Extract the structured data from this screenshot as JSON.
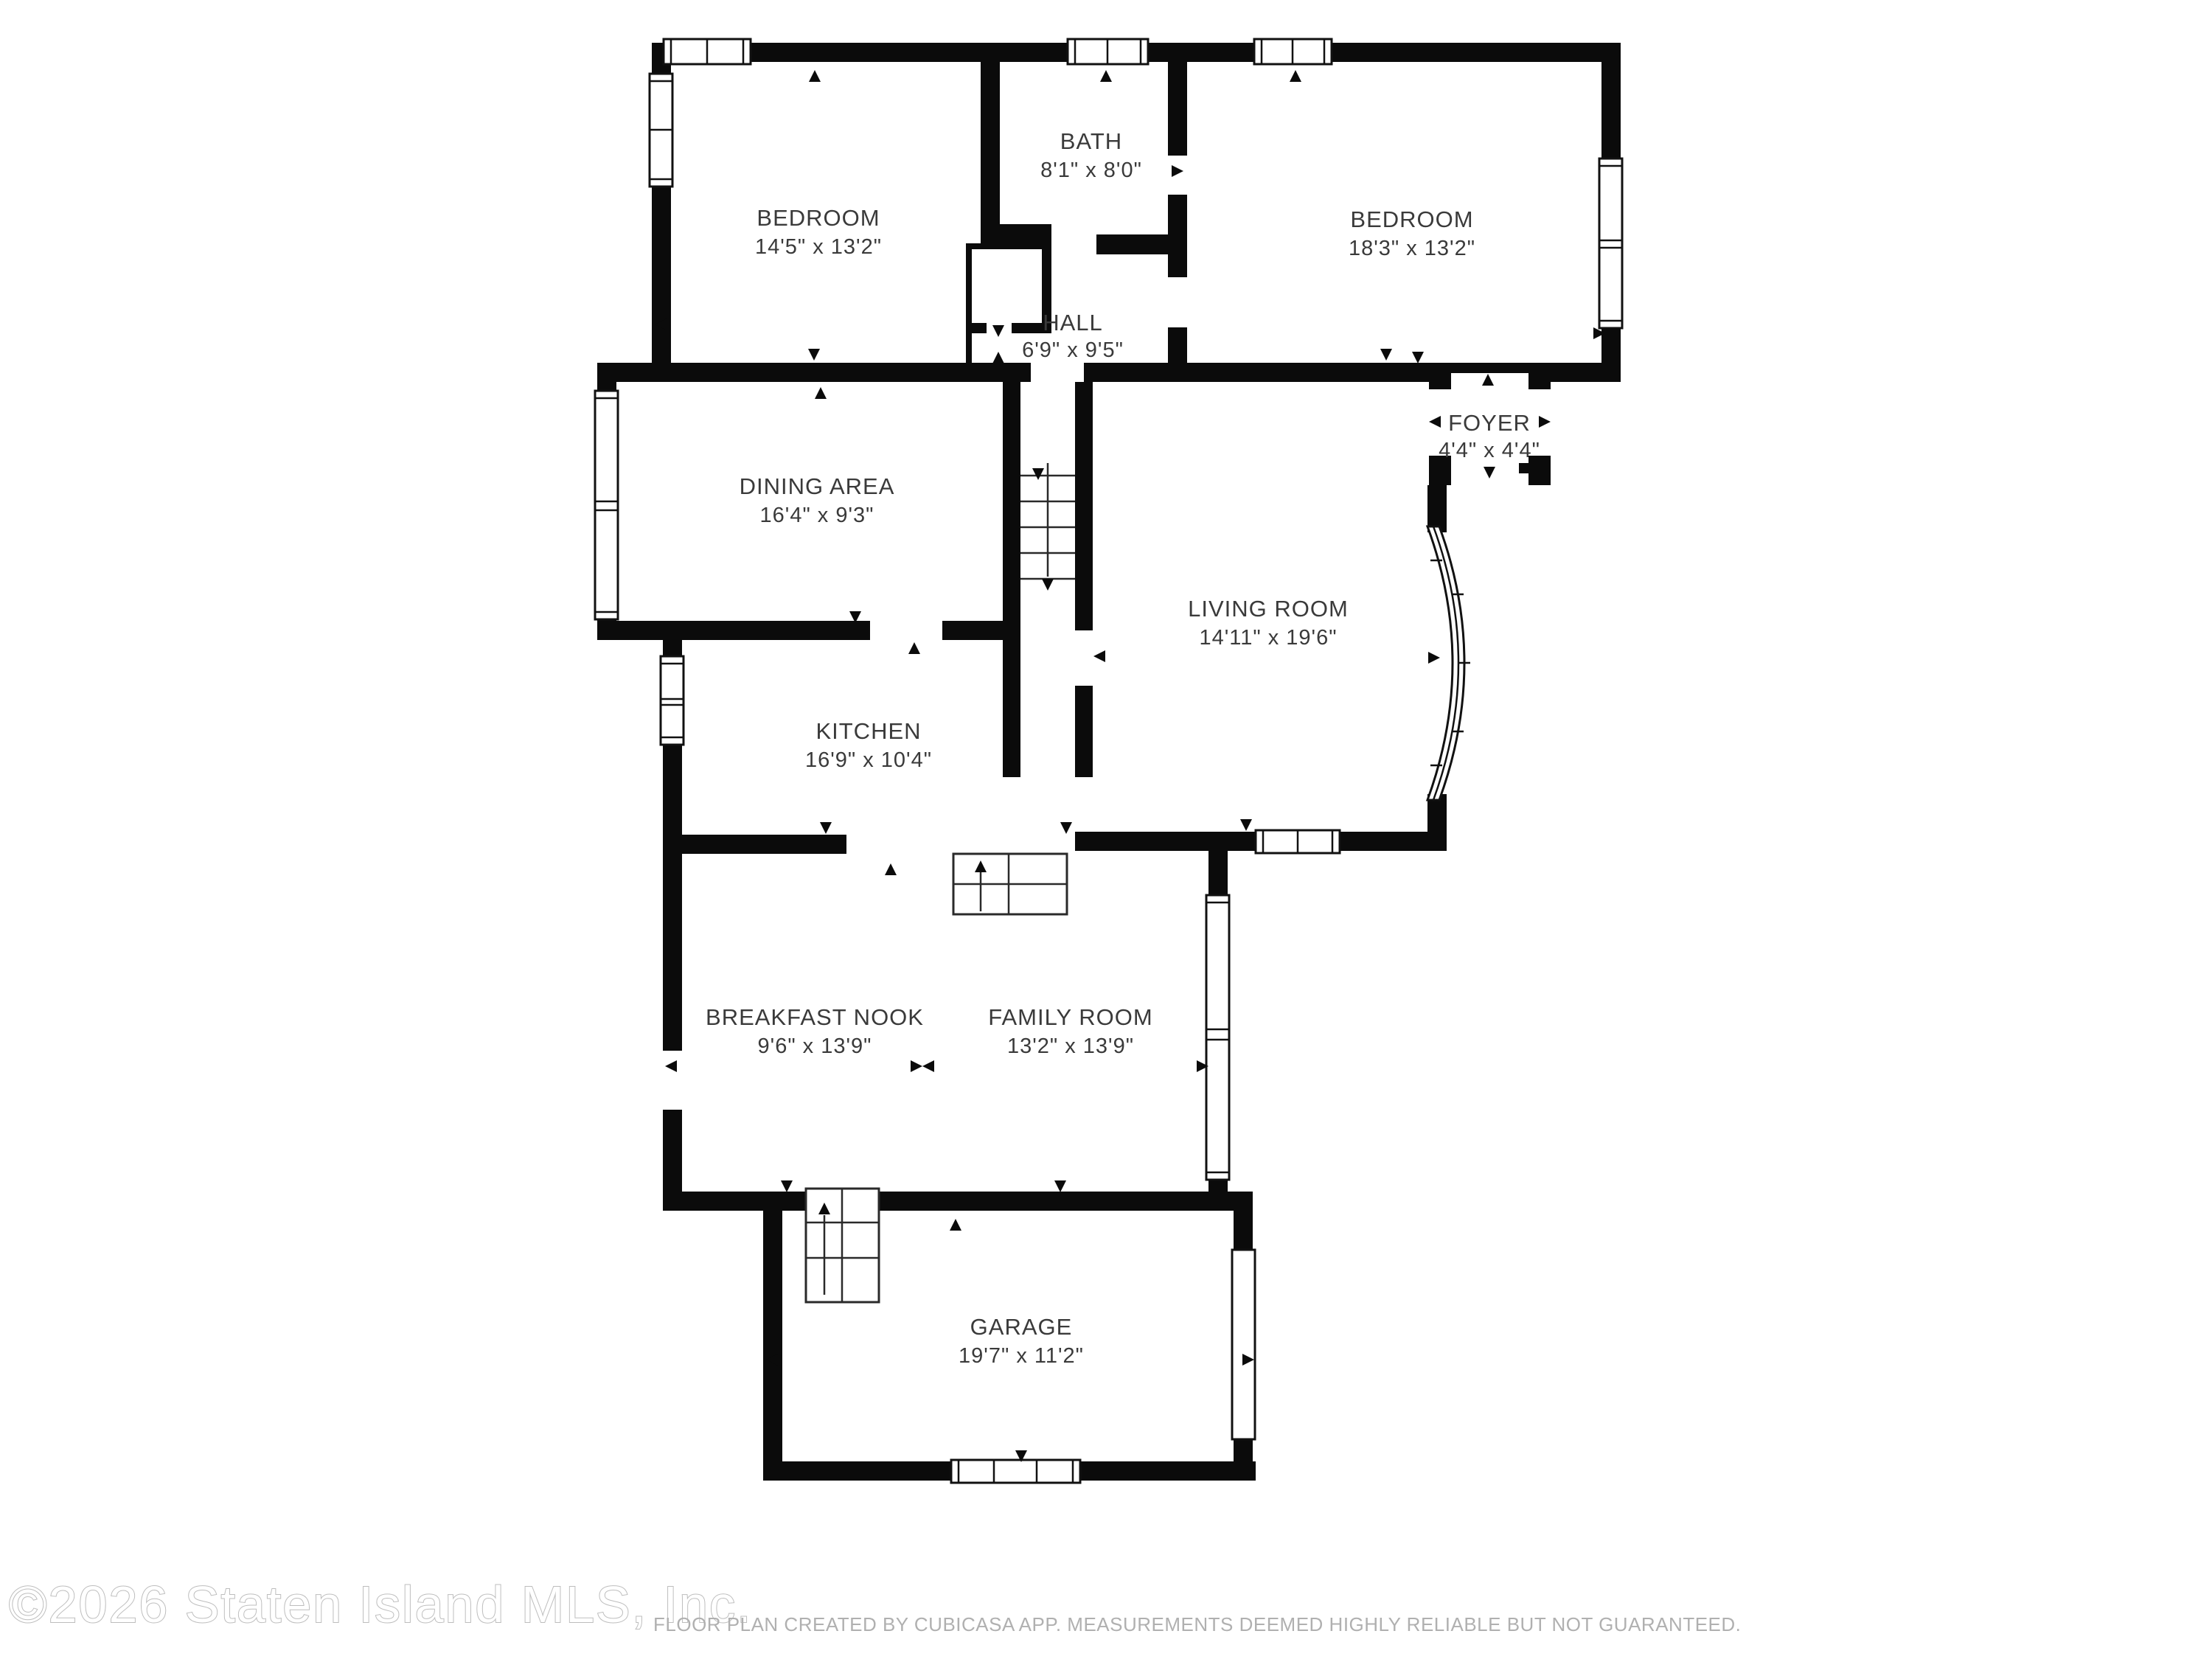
{
  "title": "Floor plan",
  "rooms": {
    "bedroom_left": {
      "name": "BEDROOM",
      "dims": "14'5\" x 13'2\""
    },
    "bath": {
      "name": "BATH",
      "dims": "8'1\" x 8'0\""
    },
    "bedroom_right": {
      "name": "BEDROOM",
      "dims": "18'3\" x 13'2\""
    },
    "hall": {
      "name": "HALL",
      "dims": "6'9\" x 9'5\""
    },
    "dining_area": {
      "name": "DINING AREA",
      "dims": "16'4\" x 9'3\""
    },
    "foyer": {
      "name": "FOYER",
      "dims": "4'4\" x 4'4\""
    },
    "living_room": {
      "name": "LIVING ROOM",
      "dims": "14'11\" x 19'6\""
    },
    "kitchen": {
      "name": "KITCHEN",
      "dims": "16'9\" x 10'4\""
    },
    "breakfast_nook": {
      "name": "BREAKFAST NOOK",
      "dims": "9'6\" x 13'9\""
    },
    "family_room": {
      "name": "FAMILY ROOM",
      "dims": "13'2\" x 13'9\""
    },
    "garage": {
      "name": "GARAGE",
      "dims": "19'7\" x 11'2\""
    }
  },
  "watermark": {
    "copyright": "©2026 Staten Island MLS, Inc.",
    "disclaimer": "FLOOR PLAN CREATED BY CUBICASA APP. MEASUREMENTS DEEMED HIGHLY RELIABLE BUT NOT GUARANTEED."
  },
  "colors": {
    "wall": "#0b0b0b",
    "label_text": "#3a3a3a",
    "watermark_outline": "#bdbdbd",
    "disclaimer_text": "#b0b0b0",
    "background": "#ffffff"
  }
}
